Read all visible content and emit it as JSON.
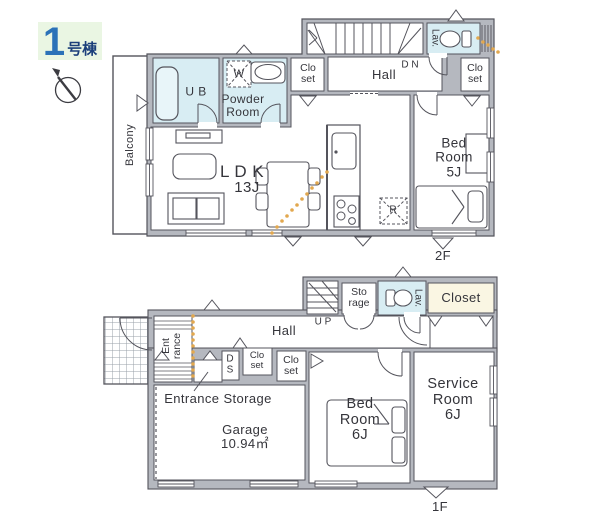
{
  "badge": {
    "number": "1",
    "suffix": "号棟"
  },
  "compass": {
    "label": "N"
  },
  "colors": {
    "wall_fill": "#b5b8bf",
    "wall_line": "#54545c",
    "wet_room": "#d8edf3",
    "closet_cream": "#faf6e3",
    "route_dots": "#e2a84f",
    "badge_bg": "#eaf6e3",
    "badge_number": "#2b72b8",
    "text": "#35353b"
  },
  "floor2": {
    "label": "2F",
    "balcony": "Balcony",
    "ub": "U B",
    "washer": "W",
    "powder_room": "Powder\nRoom",
    "closet_left": "Clo\nset",
    "hall": "Hall",
    "dn": "D N",
    "lav": "Lav.",
    "closet_right": "Clo\nset",
    "ldk": "L D K",
    "ldk_size": "13J",
    "fridge": "R",
    "bedroom": "Bed\nRoom\n5J"
  },
  "floor1": {
    "label": "1F",
    "up": "U P",
    "storage": "Sto\nrage",
    "lav": "Lav.",
    "closet_top": "Closet",
    "hall": "Hall",
    "entrance": "Ent\nrance",
    "ds": "D\nS",
    "closet_a": "Clo\nset",
    "closet_b": "Clo\nset",
    "entrance_storage": "Entrance Storage",
    "garage": "Garage",
    "garage_area": "10.94㎡",
    "bedroom": "Bed\nRoom\n6J",
    "service_room": "Service\nRoom\n6J"
  }
}
